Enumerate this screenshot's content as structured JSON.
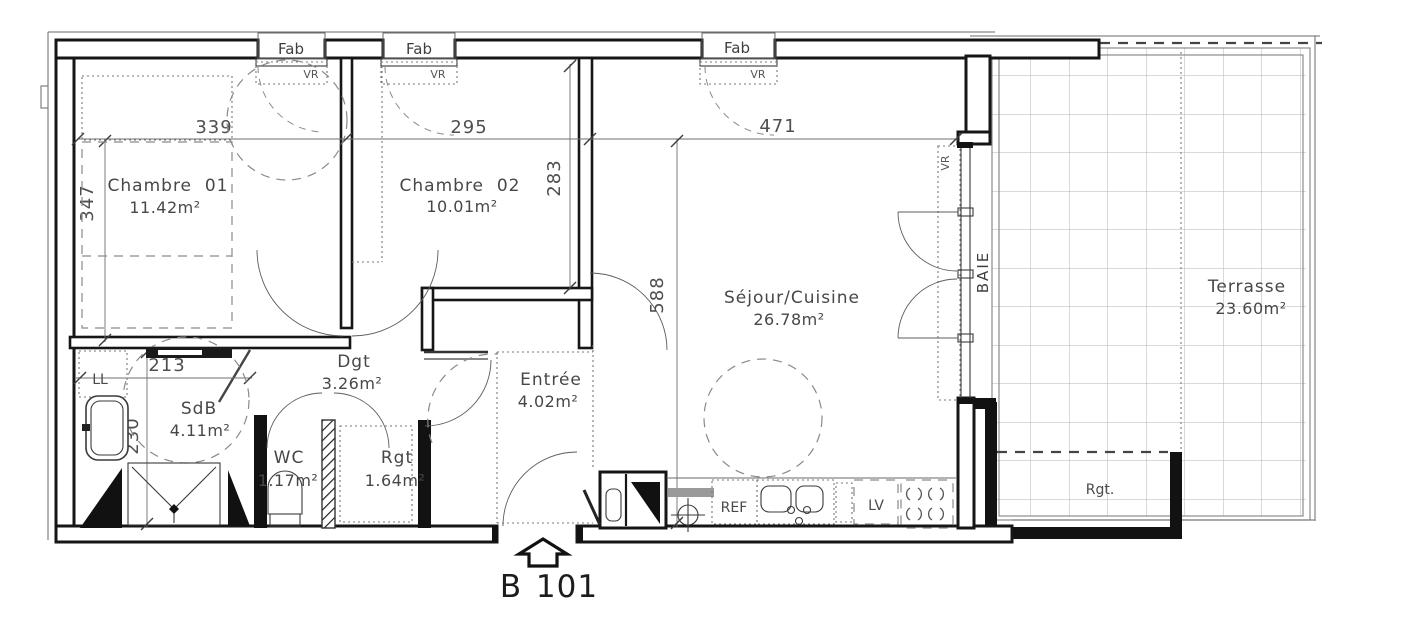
{
  "plan": {
    "unit": {
      "building": "B",
      "number": "101"
    },
    "rooms": {
      "chambre01": {
        "name": "Chambre  01",
        "area": "11.42m²"
      },
      "chambre02": {
        "name": "Chambre  02",
        "area": "10.01m²"
      },
      "sejour": {
        "name": "Séjour/Cuisine",
        "area": "26.78m²"
      },
      "dgt": {
        "name": "Dgt",
        "area": "3.26m²"
      },
      "entree": {
        "name": "Entrée",
        "area": "4.02m²"
      },
      "sdb": {
        "name": "SdB",
        "area": "4.11m²"
      },
      "wc": {
        "name": "WC",
        "area": "1.17m²"
      },
      "rgt": {
        "name": "Rgt",
        "area": "1.64m²"
      },
      "terrasse": {
        "name": "Terrasse",
        "area": "23.60m²"
      }
    },
    "dimensions_cm": {
      "ch01_width": "339",
      "ch02_width": "295",
      "sejour_width": "471",
      "ch01_height": "347",
      "ch02_height": "283",
      "sejour_height": "588",
      "sdb_width": "213",
      "sdb_height": "230"
    },
    "fixtures": {
      "washing_machine": "LL",
      "fridge": "REF",
      "dishwasher": "LV",
      "terrace_storage": "Rgt."
    },
    "openings": {
      "window": "Fab",
      "shutter": "VR",
      "bay": "BAIE"
    },
    "colors": {
      "wall": "#161616",
      "label_text": "#474747",
      "dim_text": "#4f4f4f"
    }
  }
}
